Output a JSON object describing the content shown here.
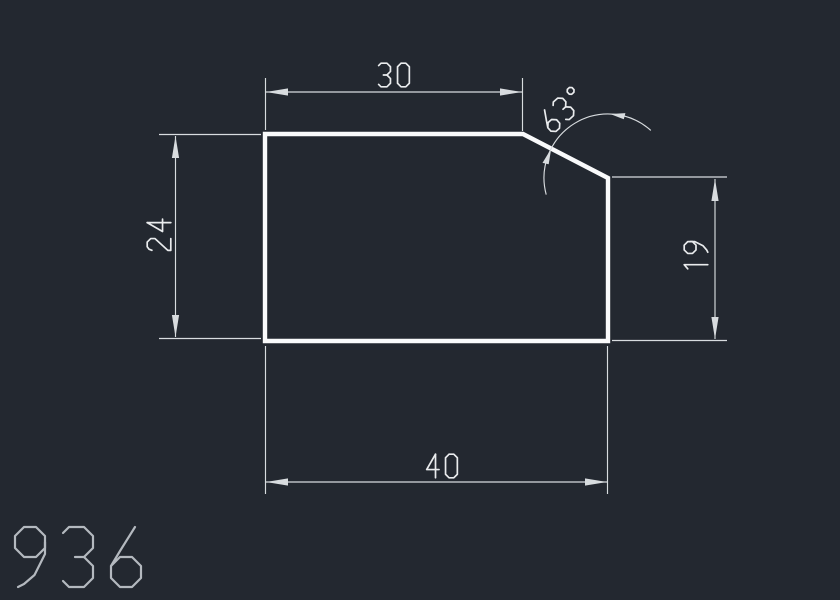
{
  "drawing": {
    "part_label": "936",
    "dimensions": {
      "top_width": "30",
      "chamfer_angle": "63°",
      "left_height": "24",
      "right_height": "19",
      "bottom_width": "40"
    },
    "colors": {
      "background": "#232830",
      "outline": "#f9fafb",
      "dimension_lines": "#d8dcdf",
      "dimension_text": "#e9ebed",
      "part_label_text": "#b4b9bf"
    }
  }
}
